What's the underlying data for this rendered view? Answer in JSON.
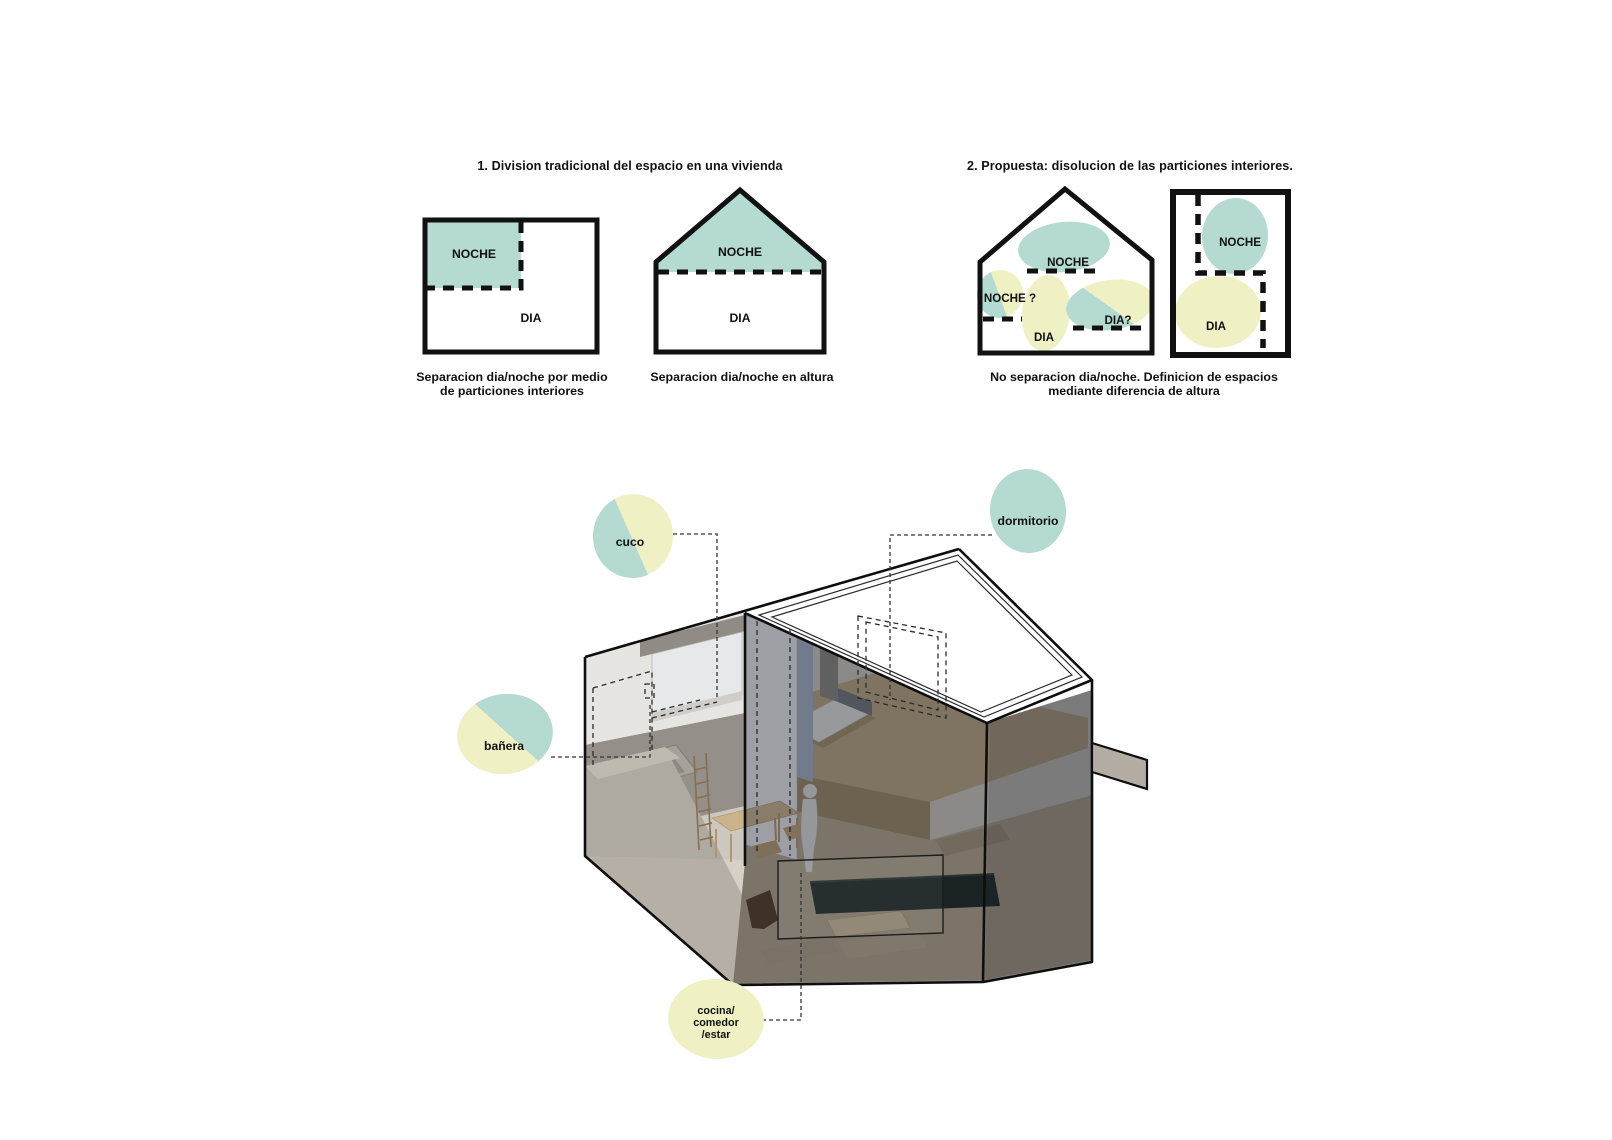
{
  "colors": {
    "teal": "#b4dad2",
    "yellow": "#eff1c4",
    "ink": "#111111",
    "concrete_light": "#b6afa5",
    "concrete_mid": "#98928a",
    "wood_floor": "#c1a981",
    "glass_overlay": "rgba(35,41,52,0.42)",
    "sofa_green": "#152019"
  },
  "section1": {
    "title": "1. Division tradicional del espacio en una vivienda",
    "rect_diagram": {
      "noche_label": "NOCHE",
      "dia_label": "DIA",
      "caption_line1": "Separacion dia/noche por medio",
      "caption_line2": "de particiones interiores"
    },
    "house_diagram": {
      "noche_label": "NOCHE",
      "dia_label": "DIA",
      "caption": "Separacion dia/noche en altura"
    }
  },
  "section2": {
    "title": "2. Propuesta: disolucion de las particiones interiores.",
    "house_diagram": {
      "noche_label": "NOCHE",
      "noche_q_label": "NOCHE ?",
      "dia_label": "DIA",
      "dia_q_label": "DIA?"
    },
    "rect_diagram": {
      "noche_label": "NOCHE",
      "dia_label": "DIA"
    },
    "caption_line1": "No separacion dia/noche. Definicion de espacios",
    "caption_line2": "mediante diferencia de altura"
  },
  "model": {
    "labels": {
      "cuco": "cuco",
      "dormitorio": "dormitorio",
      "banera": "bañera",
      "cocina_line1": "cocina/",
      "cocina_line2": "comedor",
      "cocina_line3": "/estar"
    }
  }
}
